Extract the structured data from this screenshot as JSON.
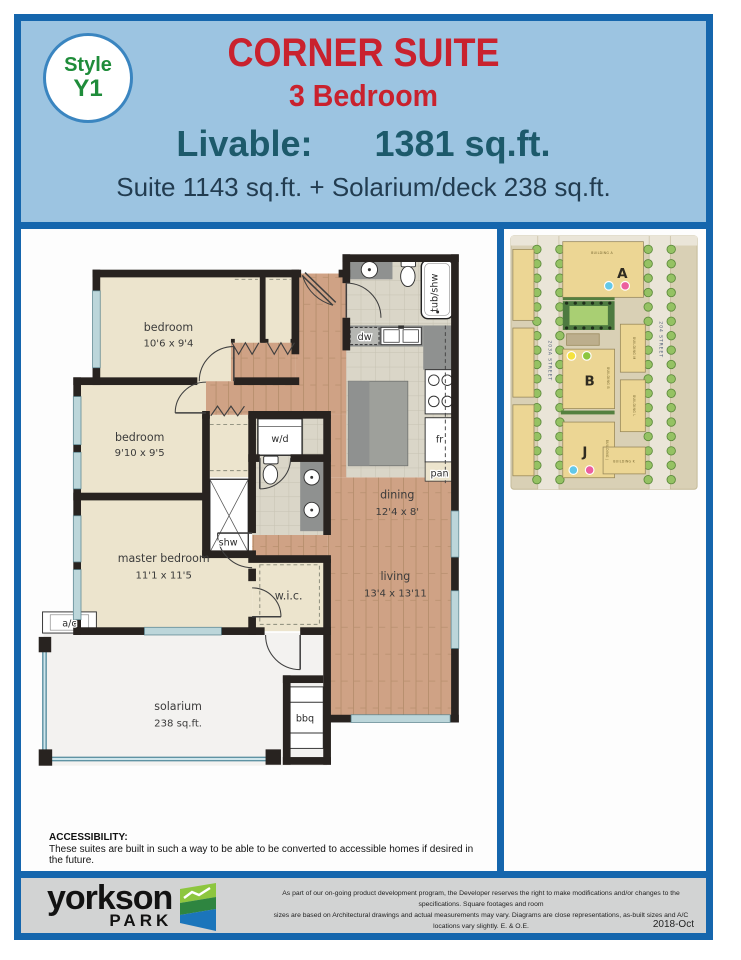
{
  "header": {
    "badge_line1": "Style",
    "badge_line2": "Y1",
    "title": "CORNER SUITE",
    "subtitle": "3 Bedroom",
    "livable_label": "Livable:",
    "livable_value": "1381 sq.ft.",
    "suite_line": "Suite 1143 sq.ft. + Solarium/deck 238 sq.ft."
  },
  "floorplan": {
    "bedroom1_name": "bedroom",
    "bedroom1_dims": "10'6 x 9'4",
    "bedroom2_name": "bedroom",
    "bedroom2_dims": "9'10 x 9'5",
    "master_name": "master bedroom",
    "master_dims": "11'1 x 11'5",
    "wic": "w.i.c.",
    "dining_name": "dining",
    "dining_dims": "12'4 x 8'",
    "living_name": "living",
    "living_dims": "13'4 x 13'11",
    "solarium_name": "solarium",
    "solarium_dims": "238 sq.ft.",
    "shw": "shw",
    "wd": "w/d",
    "dw": "dw",
    "fr": "fr",
    "pan": "pan",
    "bbq": "bbq",
    "ac": "a/c",
    "tub": "tub/shw"
  },
  "sitemap": {
    "building_a": "A",
    "building_b": "B",
    "building_j": "J",
    "street_left": "203A STREET",
    "street_right": "204 STREET",
    "small": [
      "BUILDING A",
      "BUILDING B",
      "BUILDING J",
      "BUILDING M",
      "BUILDING L",
      "BUILDING K"
    ],
    "dot_colors": {
      "blue": "#62c8e8",
      "pink": "#ec5f9e",
      "yellow": "#f5e33e",
      "green": "#8dc63f"
    }
  },
  "accessibility": {
    "heading": "ACCESSIBILITY:",
    "text": "These suites are built in such a way to be able to be converted to accessible homes if desired in the future."
  },
  "footer": {
    "brand_top": "yorkson",
    "brand_bottom": "PARK",
    "disclaimer_line1": "As part of our on-going product development program, the Developer reserves the right to make modifications and/or changes to the specifications. Square footages and room",
    "disclaimer_line2": "sizes are based on Architectural drawings and actual measurements may vary. Diagrams are close representations, as-built sizes and A/C locations vary slightly. E. & O.E.",
    "date": "2018-Oct"
  }
}
